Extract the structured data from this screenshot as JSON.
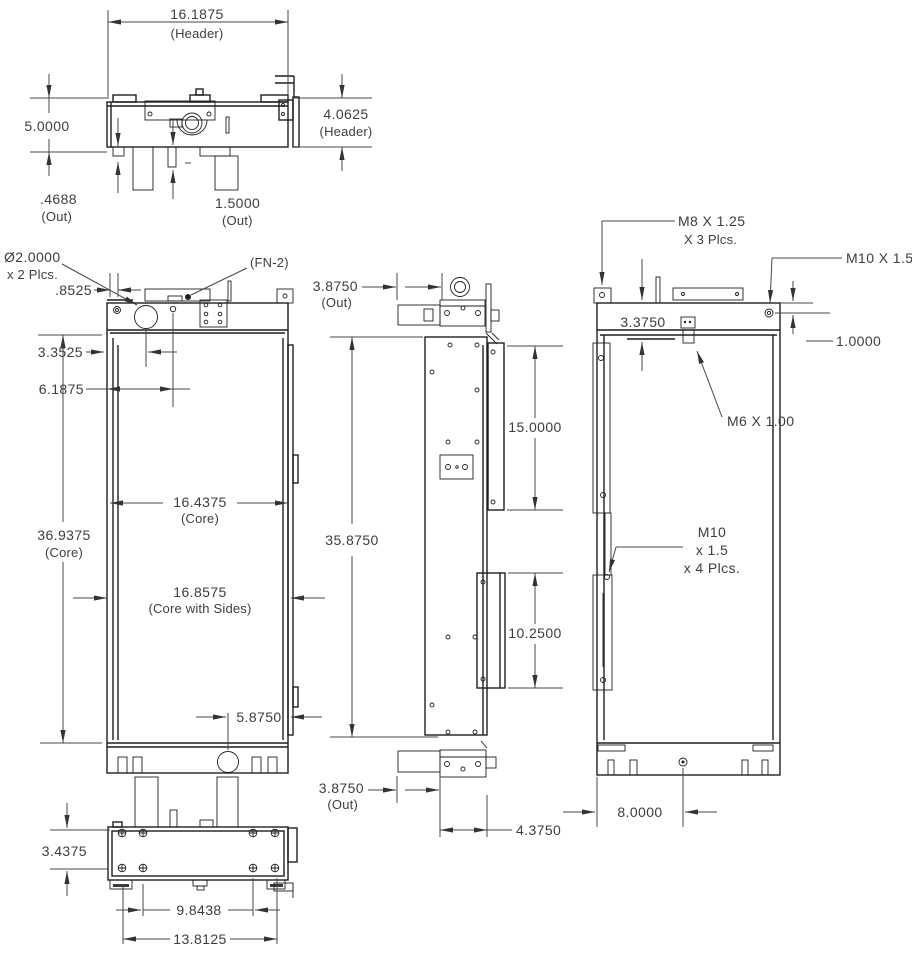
{
  "drawing": {
    "top_view": {
      "header_width": "16.1875",
      "header_width_note": "(Header)",
      "overall_height": "5.0000",
      "header_depth": "4.0625",
      "header_depth_note": "(Header)",
      "out_tab": ".4688",
      "out_tab_note": "(Out)",
      "out_pipe": "1.5000",
      "out_pipe_note": "(Out)"
    },
    "front_view": {
      "filler_dia": "Ø2.0000",
      "filler_dia_note": "x 2 Plcs.",
      "fastener_note": "(FN-2)",
      "side_offset": ".8525",
      "filler_offset": "3.3525",
      "hole_offset": "6.1875",
      "core_height": "36.9375",
      "core_height_note": "(Core)",
      "core_width": "16.4375",
      "core_width_note": "(Core)",
      "core_sides_width": "16.8575",
      "core_sides_width_note": "(Core with Sides)",
      "drain_offset": "5.8750"
    },
    "side_view": {
      "out_top": "3.8750",
      "out_top_note": "(Out)",
      "overall_height": "35.8750",
      "upper_bracket": "15.0000",
      "lower_bracket": "10.2500",
      "out_bottom": "3.8750",
      "out_bottom_note": "(Out)",
      "depth": "4.3750"
    },
    "rear_view": {
      "m8_thread": "M8 X 1.25",
      "m8_thread_note": "X 3 Plcs.",
      "m10_top_thread": "M10 X 1.5",
      "tank_depth": "3.3750",
      "insert_offset": "1.0000",
      "m6_thread": "M6 X 1.00",
      "m10_side_line1": "M10",
      "m10_side_line2": "x 1.5",
      "m10_side_line3": "x 4 Plcs.",
      "drain_offset": "8.0000"
    },
    "bottom_view": {
      "depth": "3.4375",
      "hole_span_inner": "9.8438",
      "hole_span_outer": "13.8125"
    }
  }
}
